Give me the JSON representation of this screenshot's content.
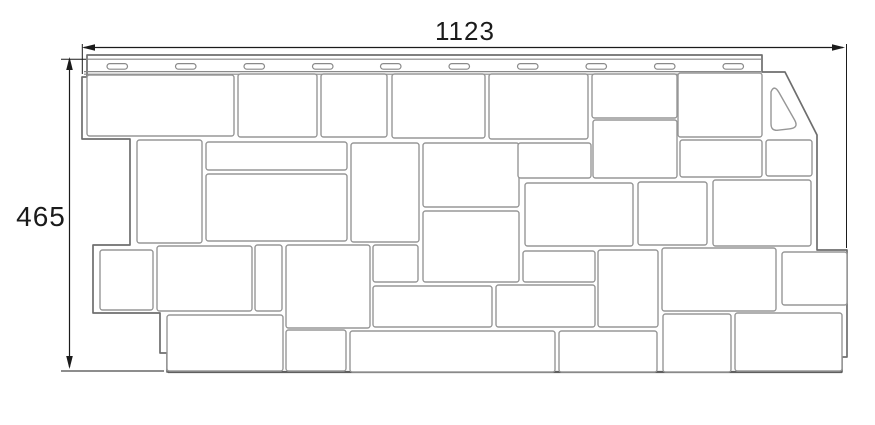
{
  "diagram": {
    "description": "Dimensioned line drawing of a facade siding panel with stone pattern and nailing strip",
    "width_label": "1123",
    "height_label": "465",
    "colors": {
      "background": "#ffffff",
      "stone_line": "#979797",
      "panel_line": "#6e6e6e",
      "strip_line": "#8a8a8a",
      "bottom_edge": "#5f5f5f",
      "dimension": "#1b1b1b"
    },
    "panel_outline": [
      [
        87,
        55
      ],
      [
        762,
        55
      ],
      [
        762,
        72
      ],
      [
        785,
        72
      ],
      [
        817,
        135
      ],
      [
        817,
        250
      ],
      [
        847,
        250
      ],
      [
        847,
        357
      ],
      [
        842,
        357
      ],
      [
        842,
        372
      ],
      [
        167,
        372
      ],
      [
        167,
        353
      ],
      [
        160,
        353
      ],
      [
        160,
        313
      ],
      [
        93,
        313
      ],
      [
        93,
        245
      ],
      [
        130,
        245
      ],
      [
        130,
        139
      ],
      [
        82,
        139
      ],
      [
        82,
        77
      ],
      [
        87,
        77
      ]
    ],
    "strip_lines": [
      [
        87,
        59.2,
        762,
        59.2
      ],
      [
        84,
        71.6,
        762,
        71.6
      ],
      [
        84,
        74.2,
        762,
        74.2
      ]
    ],
    "nail_slots": {
      "xs": [
        107,
        175.5,
        244,
        312.5,
        380.5,
        449,
        517.5,
        586,
        654.5,
        723
      ],
      "y": 63.6,
      "w": 20.5,
      "h": 5.6,
      "rx": 2.8
    },
    "stones": [
      [
        87,
        75,
        147,
        61
      ],
      [
        238,
        74,
        79,
        63
      ],
      [
        321,
        74,
        66,
        63
      ],
      [
        392,
        74,
        93,
        64
      ],
      [
        489,
        74,
        99,
        65
      ],
      [
        592,
        74,
        85,
        44
      ],
      [
        678,
        73,
        84,
        64
      ],
      [
        137,
        140,
        65,
        103
      ],
      [
        206,
        142,
        141,
        28
      ],
      [
        206,
        174,
        141,
        67
      ],
      [
        351,
        143,
        68,
        99
      ],
      [
        423,
        143,
        96,
        64
      ],
      [
        423,
        211,
        96,
        71
      ],
      [
        518,
        143,
        73,
        35
      ],
      [
        593,
        120,
        84,
        58
      ],
      [
        525,
        183,
        108,
        63
      ],
      [
        638,
        182,
        69,
        63
      ],
      [
        680,
        140,
        82,
        37
      ],
      [
        766,
        140,
        46,
        36
      ],
      [
        713,
        180,
        98,
        66
      ],
      [
        100,
        250,
        53,
        60
      ],
      [
        157,
        246,
        95,
        65
      ],
      [
        255,
        245,
        27,
        66
      ],
      [
        286,
        245,
        84,
        83
      ],
      [
        373,
        245,
        45,
        37
      ],
      [
        373,
        286,
        119,
        41
      ],
      [
        496,
        285,
        99,
        42
      ],
      [
        523,
        251,
        72,
        31
      ],
      [
        598,
        250,
        60,
        77
      ],
      [
        662,
        248,
        114,
        63
      ],
      [
        782,
        252,
        65,
        53
      ],
      [
        167,
        315,
        116,
        56
      ],
      [
        286,
        330,
        60,
        41
      ],
      [
        350,
        331,
        205,
        41
      ],
      [
        559,
        331,
        98,
        41
      ],
      [
        663,
        314,
        68,
        58
      ],
      [
        735,
        313,
        107,
        58
      ]
    ],
    "stone_corner_radius": 2.5,
    "corner_gusset_path": "M 771 94 L 771 124 Q 771 131 778 130.2 L 790 128.8 Q 799 127.8 794.6 120 L 779 92.5 Q 774 84 771 92 Z",
    "bottom_edge_line": [
      168,
      372,
      842,
      372
    ],
    "dimensions": {
      "top": {
        "line": [
          84,
          47.5,
          843,
          47.5
        ],
        "arrows": [
          [
            82,
            47.5,
            "left"
          ],
          [
            845,
            47.5,
            "right"
          ]
        ],
        "extensions": [
          [
            82.3,
            44,
            82.3,
            74
          ],
          [
            846.5,
            44,
            846.5,
            248
          ]
        ]
      },
      "left": {
        "line": [
          69.5,
          59,
          69.5,
          367
        ],
        "arrows": [
          [
            69.5,
            57,
            "up"
          ],
          [
            69.5,
            369,
            "down"
          ]
        ],
        "extensions": [
          [
            61,
            59.2,
            86,
            59.2
          ],
          [
            61,
            371,
            164,
            371
          ]
        ]
      }
    }
  }
}
